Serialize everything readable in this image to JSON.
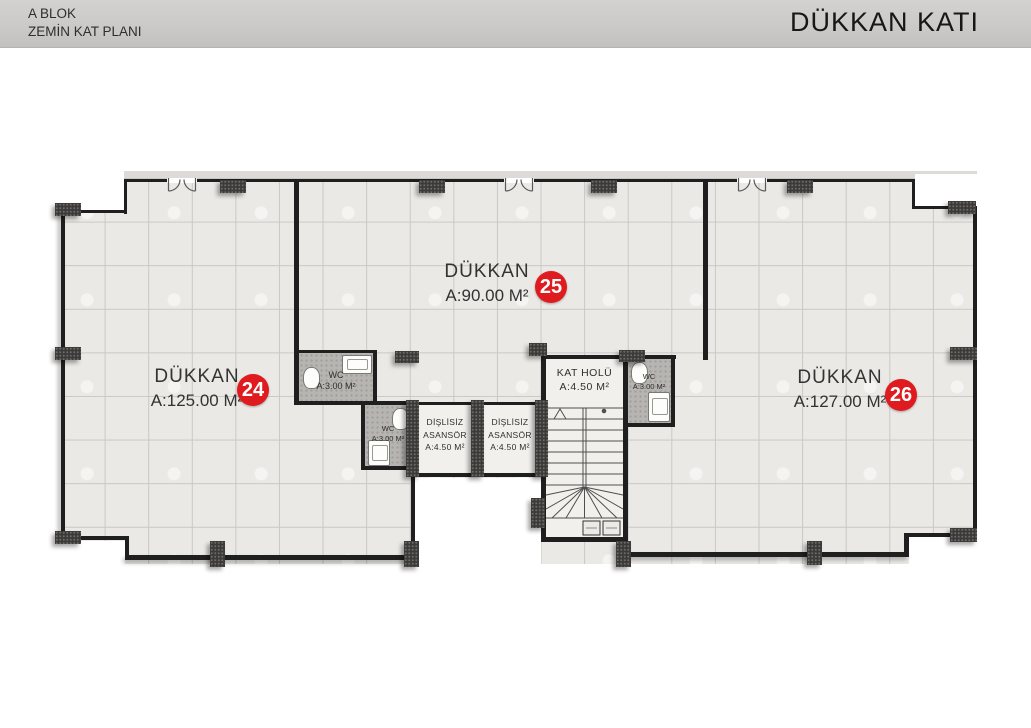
{
  "header": {
    "block_label": "A BLOK",
    "plan_label": "ZEMİN KAT PLANI",
    "title": "DÜKKAN KATI"
  },
  "colors": {
    "unit_badge": "#e01b20"
  },
  "units": [
    {
      "name": "DÜKKAN",
      "area": "A:125.00 M²",
      "number": "24"
    },
    {
      "name": "DÜKKAN",
      "area": "A:90.00 M²",
      "number": "25"
    },
    {
      "name": "DÜKKAN",
      "area": "A:127.00 M²",
      "number": "26"
    }
  ],
  "rooms": {
    "wc": {
      "name": "WC",
      "area": "A:3.00 M²"
    },
    "elevator": {
      "line1": "DİŞLİSİZ",
      "line2": "ASANSÖR",
      "area": "A:4.50 M²"
    },
    "hall": {
      "name": "KAT HOLÜ",
      "area": "A:4.50 M²"
    }
  }
}
